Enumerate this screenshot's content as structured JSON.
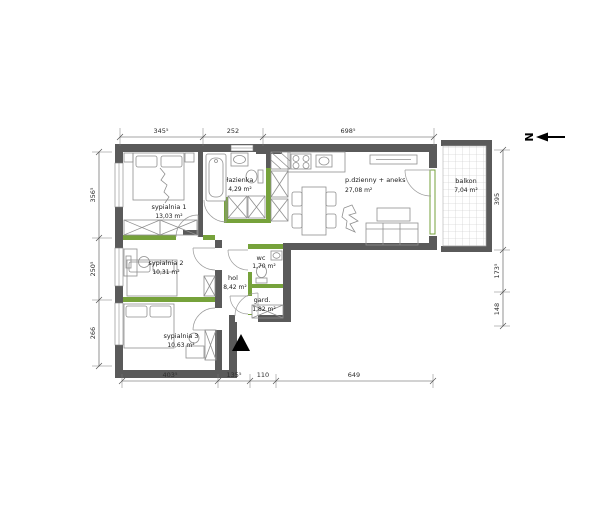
{
  "north_label": "N",
  "rooms": {
    "sypialnia1": {
      "name": "sypialnia 1",
      "area": "13,03 m²"
    },
    "sypialnia2": {
      "name": "sypialnia 2",
      "area": "10,31 m²"
    },
    "sypialnia3": {
      "name": "sypialnia 3",
      "area": "10,63 m²"
    },
    "lazienka": {
      "name": "łazienka",
      "area": "4,29 m²"
    },
    "wc": {
      "name": "wc",
      "area": "1,70 m²"
    },
    "hol": {
      "name": "hol",
      "area": "8,42 m²"
    },
    "garderoba": {
      "name": "gard.",
      "area": "1,82 m²"
    },
    "dzienny": {
      "name": "p.dzienny + aneks",
      "area": "27,08 m²"
    },
    "balkon": {
      "name": "balkon",
      "area": "7,04 m²"
    }
  },
  "dimensions": {
    "top": [
      "345⁵",
      "252",
      "698⁵"
    ],
    "bottom": [
      "403⁵",
      "135⁵",
      "110",
      "649"
    ],
    "left": [
      "356⁵",
      "250⁵",
      "266"
    ],
    "right": [
      "395",
      "173⁵",
      "148"
    ]
  },
  "colors": {
    "structural_wall": "#5a5a5a",
    "partition_wall_accent": "#76a23b",
    "furniture_line": "#8f8f8f",
    "background": "#ffffff"
  }
}
